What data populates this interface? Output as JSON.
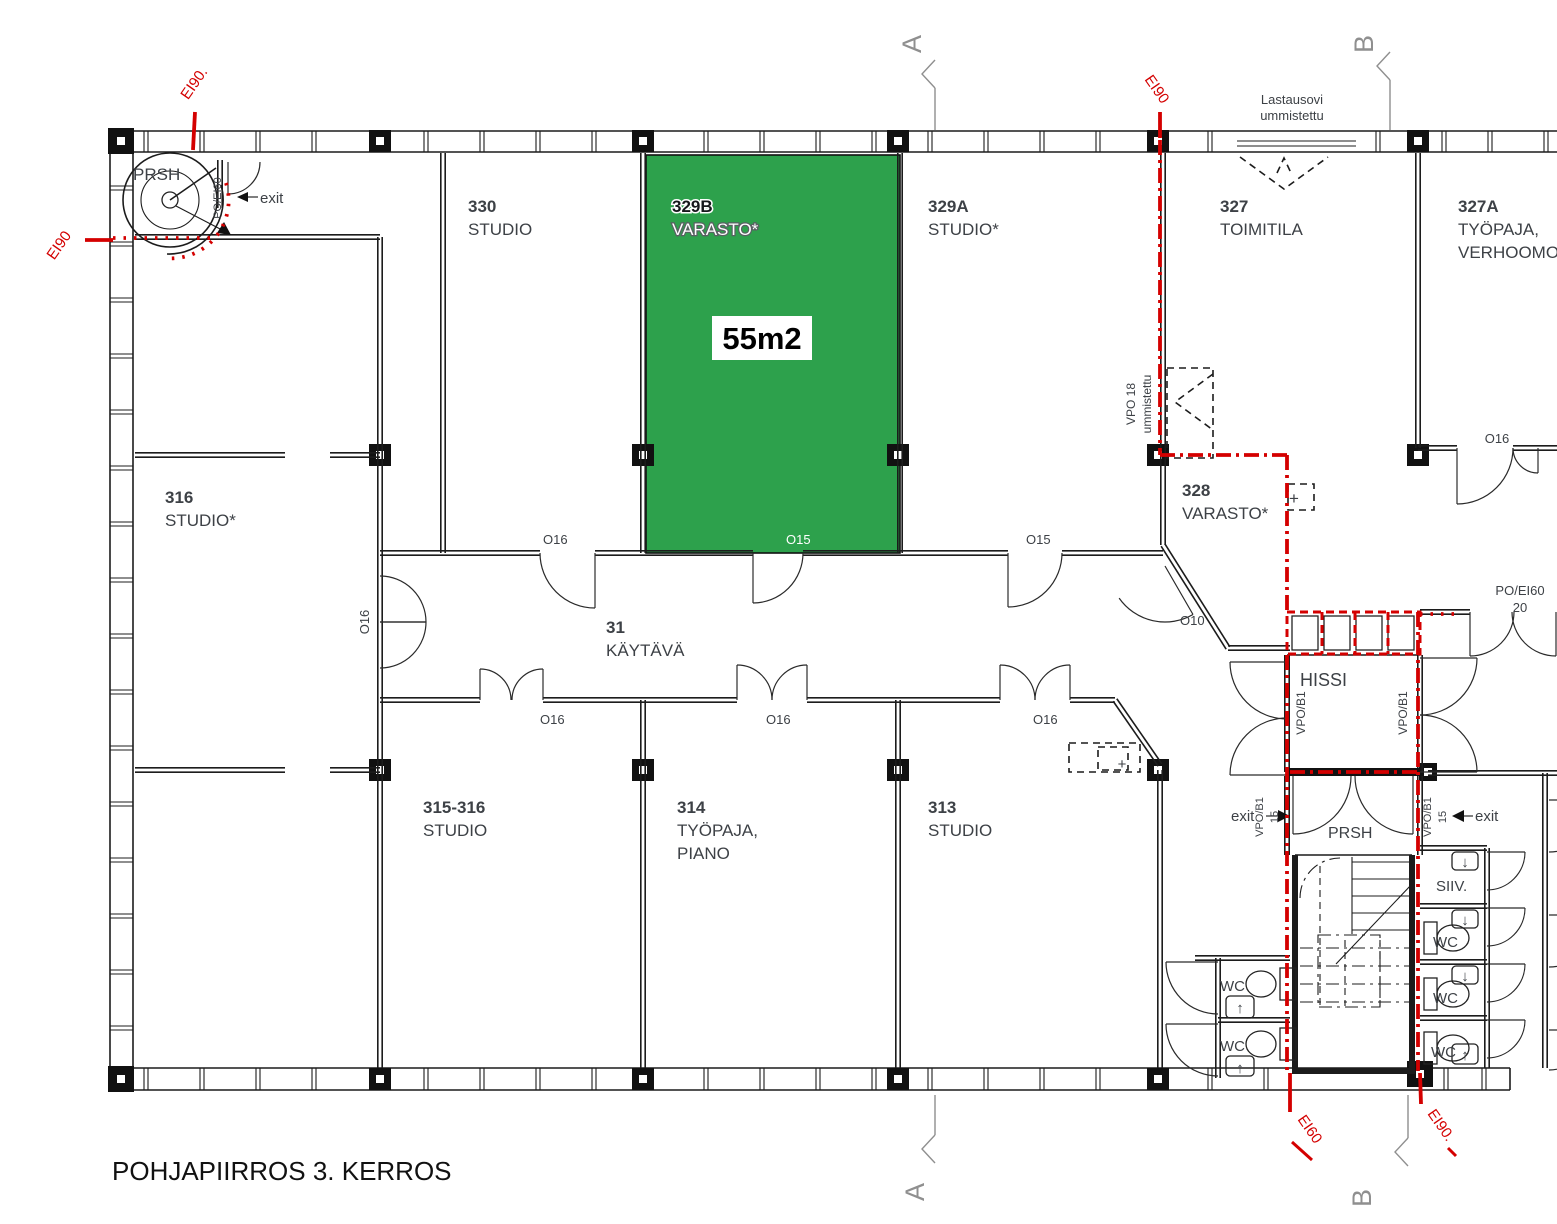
{
  "title": "POHJAPIIRROS 3. KERROS",
  "colors": {
    "highlight_green": "#2da14c",
    "fire_red": "#d40000",
    "wall_black": "#1c1c1c",
    "text_dark": "#3d4146",
    "marker_gray": "#8f8f8f"
  },
  "highlighted_room": {
    "id": "329B",
    "type": "VARASTO*",
    "area_label": "55m2"
  },
  "labels": [
    {
      "n": "plan-title",
      "t": "POHJAPIIRROS 3. KERROS",
      "x": 112,
      "y": 1180,
      "s": 26,
      "c": "#111111"
    },
    {
      "n": "room-330-number",
      "t": "330",
      "x": 468,
      "y": 212,
      "b": 1
    },
    {
      "n": "room-330-type",
      "t": "STUDIO",
      "x": 468,
      "y": 235
    },
    {
      "n": "room-329b-number",
      "t": "329B",
      "x": 672,
      "y": 212,
      "b": 1,
      "c": "#15181b",
      "st": "#ffffff",
      "sw": 3
    },
    {
      "n": "room-329b-type",
      "t": "VARASTO*",
      "x": 672,
      "y": 235,
      "c": "#ffffff",
      "st": "#5a5f63",
      "sw": 2.4
    },
    {
      "n": "room-329b-area",
      "t": "55m2",
      "x": 762,
      "y": 349,
      "s": 31,
      "b": 1,
      "c": "#000000",
      "a": "middle"
    },
    {
      "n": "room-329a-number",
      "t": "329A",
      "x": 928,
      "y": 212,
      "b": 1
    },
    {
      "n": "room-329a-type",
      "t": "STUDIO*",
      "x": 928,
      "y": 235
    },
    {
      "n": "room-327-number",
      "t": "327",
      "x": 1220,
      "y": 212,
      "b": 1
    },
    {
      "n": "room-327-type",
      "t": "TOIMITILA",
      "x": 1220,
      "y": 235
    },
    {
      "n": "room-327a-number",
      "t": "327A",
      "x": 1458,
      "y": 212,
      "b": 1
    },
    {
      "n": "room-327a-type-line1",
      "t": "TYÖPAJA,",
      "x": 1458,
      "y": 235
    },
    {
      "n": "room-327a-type-line2",
      "t": "VERHOOMO",
      "x": 1458,
      "y": 258
    },
    {
      "n": "room-316-number",
      "t": "316",
      "x": 165,
      "y": 503,
      "b": 1
    },
    {
      "n": "room-316-type",
      "t": "STUDIO*",
      "x": 165,
      "y": 526
    },
    {
      "n": "room-31-number",
      "t": "31",
      "x": 606,
      "y": 633,
      "b": 1
    },
    {
      "n": "room-31-type",
      "t": "KÄYTÄVÄ",
      "x": 606,
      "y": 656
    },
    {
      "n": "room-328-number",
      "t": "328",
      "x": 1182,
      "y": 496,
      "b": 1
    },
    {
      "n": "room-328-type",
      "t": "VARASTO*",
      "x": 1182,
      "y": 519
    },
    {
      "n": "room-315-316-number",
      "t": "315-316",
      "x": 423,
      "y": 813,
      "b": 1
    },
    {
      "n": "room-315-316-type",
      "t": "STUDIO",
      "x": 423,
      "y": 836
    },
    {
      "n": "room-314-number",
      "t": "314",
      "x": 677,
      "y": 813,
      "b": 1
    },
    {
      "n": "room-314-type-line1",
      "t": "TYÖPAJA,",
      "x": 677,
      "y": 836
    },
    {
      "n": "room-314-type-line2",
      "t": "PIANO",
      "x": 677,
      "y": 859
    },
    {
      "n": "room-313-number",
      "t": "313",
      "x": 928,
      "y": 813,
      "b": 1
    },
    {
      "n": "room-313-type",
      "t": "STUDIO",
      "x": 928,
      "y": 836
    },
    {
      "n": "label-hissi",
      "t": "HISSI",
      "x": 1300,
      "y": 686,
      "s": 18
    },
    {
      "n": "label-prsh-stair",
      "t": "PRSH",
      "x": 133,
      "y": 180,
      "s": 17
    },
    {
      "n": "label-prsh-lobby",
      "t": "PRSH",
      "x": 1328,
      "y": 838,
      "s": 16
    },
    {
      "n": "label-siiv",
      "t": "SIIV.",
      "x": 1436,
      "y": 891,
      "s": 15
    },
    {
      "n": "label-wc-right-1",
      "t": "WC",
      "x": 1433,
      "y": 947,
      "s": 15
    },
    {
      "n": "label-wc-right-2",
      "t": "WC",
      "x": 1433,
      "y": 1003,
      "s": 15
    },
    {
      "n": "label-wc-right-3",
      "t": "WC",
      "x": 1431,
      "y": 1057,
      "s": 15
    },
    {
      "n": "label-wc-left-1",
      "t": "WC",
      "x": 1220,
      "y": 991,
      "s": 15
    },
    {
      "n": "label-wc-left-2",
      "t": "WC",
      "x": 1220,
      "y": 1051,
      "s": 15
    },
    {
      "n": "door-o16-330",
      "t": "O16",
      "x": 543,
      "y": 544,
      "s": 13
    },
    {
      "n": "door-o15-329b",
      "t": "O15",
      "x": 786,
      "y": 544,
      "s": 13,
      "c": "#ffffff"
    },
    {
      "n": "door-o15-329a",
      "t": "O15",
      "x": 1026,
      "y": 544,
      "s": 13
    },
    {
      "n": "door-o16-315-316",
      "t": "O16",
      "x": 540,
      "y": 724,
      "s": 13
    },
    {
      "n": "door-o16-314",
      "t": "O16",
      "x": 766,
      "y": 724,
      "s": 13
    },
    {
      "n": "door-o16-313",
      "t": "O16",
      "x": 1033,
      "y": 724,
      "s": 13
    },
    {
      "n": "door-o16-corridor-west",
      "t": "O16",
      "x": 369,
      "y": 622,
      "s": 13,
      "r": -90,
      "a": "middle"
    },
    {
      "n": "door-o16-327a",
      "t": "O16",
      "x": 1497,
      "y": 443,
      "s": 13,
      "a": "middle"
    },
    {
      "n": "door-o10",
      "t": "O10",
      "x": 1180,
      "y": 625,
      "s": 13
    },
    {
      "n": "note-lastausovi-line1",
      "t": "Lastausovi",
      "x": 1292,
      "y": 104,
      "s": 13,
      "a": "middle"
    },
    {
      "n": "note-lastausovi-line2",
      "t": "ummistettu",
      "x": 1292,
      "y": 120,
      "s": 13,
      "a": "middle"
    },
    {
      "n": "note-vpo18-line1",
      "t": "VPO 18",
      "x": 1135,
      "y": 404,
      "s": 12,
      "r": -90,
      "a": "middle"
    },
    {
      "n": "note-vpo18-line2",
      "t": "ummistettu",
      "x": 1151,
      "y": 404,
      "s": 12,
      "r": -90,
      "a": "middle"
    },
    {
      "n": "note-po-ei60-line1",
      "t": "PO/EI60",
      "x": 1520,
      "y": 595,
      "s": 13,
      "a": "middle"
    },
    {
      "n": "note-po-ei60-line2",
      "t": "20",
      "x": 1520,
      "y": 612,
      "s": 13,
      "a": "middle"
    },
    {
      "n": "note-po-ei60-stair",
      "t": "PO/EI60",
      "x": 221,
      "y": 198,
      "s": 11,
      "r": -90,
      "a": "middle"
    },
    {
      "n": "exit-label-stair",
      "t": "exit",
      "x": 260,
      "y": 203,
      "s": 15
    },
    {
      "n": "exit-label-lobby",
      "t": "exit",
      "x": 1231,
      "y": 821,
      "s": 15
    },
    {
      "n": "exit-label-right",
      "t": "exit",
      "x": 1475,
      "y": 821,
      "s": 15
    },
    {
      "n": "note-vpo-b1-hissi-left",
      "t": "VPO/B1",
      "x": 1305,
      "y": 713,
      "s": 12,
      "r": -90,
      "a": "middle"
    },
    {
      "n": "note-vpo-b1-hissi-right",
      "t": "VPO/B1",
      "x": 1407,
      "y": 713,
      "s": 12,
      "r": -90,
      "a": "middle"
    },
    {
      "n": "note-vpo-b1-15-left-line1",
      "t": "VPO/B1",
      "x": 1263,
      "y": 817,
      "s": 11,
      "r": -90,
      "a": "middle"
    },
    {
      "n": "note-vpo-b1-15-left-line2",
      "t": "15",
      "x": 1278,
      "y": 817,
      "s": 11,
      "r": -90,
      "a": "middle"
    },
    {
      "n": "note-vpo-b1-15-right-line1",
      "t": "VPO/B1",
      "x": 1431,
      "y": 817,
      "s": 11,
      "r": -90,
      "a": "middle"
    },
    {
      "n": "note-vpo-b1-15-right-line2",
      "t": "15",
      "x": 1446,
      "y": 817,
      "s": 11,
      "r": -90,
      "a": "middle"
    },
    {
      "n": "fire-ei90-top-left",
      "t": "EI90.",
      "x": 198,
      "y": 86,
      "s": 15,
      "c": "#d40000",
      "r": -55,
      "a": "middle"
    },
    {
      "n": "fire-ei90-left",
      "t": "EI90",
      "x": 63,
      "y": 248,
      "s": 15,
      "c": "#d40000",
      "r": -55,
      "a": "middle"
    },
    {
      "n": "fire-ei90-top-middle",
      "t": "EI90",
      "x": 1153,
      "y": 92,
      "s": 15,
      "c": "#d40000",
      "r": 55,
      "a": "middle"
    },
    {
      "n": "fire-ei60-bottom-left",
      "t": "EI60",
      "x": 1306,
      "y": 1132,
      "s": 15,
      "c": "#d40000",
      "r": 55,
      "a": "middle"
    },
    {
      "n": "fire-ei90-bottom-right",
      "t": "EI90.",
      "x": 1437,
      "y": 1128,
      "s": 15,
      "c": "#d40000",
      "r": 55,
      "a": "middle"
    },
    {
      "n": "section-marker-a-top",
      "t": "A",
      "x": 921,
      "y": 44,
      "s": 27,
      "c": "#8f8f8f",
      "r": -90,
      "a": "middle"
    },
    {
      "n": "section-marker-a-bottom",
      "t": "A",
      "x": 924,
      "y": 1192,
      "s": 27,
      "c": "#8f8f8f",
      "r": -90,
      "a": "middle"
    },
    {
      "n": "section-marker-b-top",
      "t": "B",
      "x": 1373,
      "y": 44,
      "s": 27,
      "c": "#8f8f8f",
      "r": -90,
      "a": "middle"
    },
    {
      "n": "section-marker-b-bottom",
      "t": "B",
      "x": 1371,
      "y": 1198,
      "s": 27,
      "c": "#8f8f8f",
      "r": -90,
      "a": "middle"
    },
    {
      "n": "sink-arrow-siiv",
      "t": "↓",
      "x": 1465,
      "y": 867,
      "s": 15,
      "a": "middle"
    },
    {
      "n": "sink-arrow-wc-right-1",
      "t": "↓",
      "x": 1465,
      "y": 925,
      "s": 15,
      "a": "middle"
    },
    {
      "n": "sink-arrow-wc-right-2",
      "t": "↓",
      "x": 1465,
      "y": 981,
      "s": 15,
      "a": "middle"
    },
    {
      "n": "sink-arrow-wc-right-3",
      "t": "↑",
      "x": 1465,
      "y": 1060,
      "s": 15,
      "a": "middle"
    },
    {
      "n": "sink-arrow-wc-left-1",
      "t": "↑",
      "x": 1240,
      "y": 1013,
      "s": 15,
      "a": "middle"
    },
    {
      "n": "sink-arrow-wc-left-2",
      "t": "↑",
      "x": 1240,
      "y": 1073,
      "s": 15,
      "a": "middle"
    },
    {
      "n": "symbol-plus-328",
      "t": "+",
      "x": 1294,
      "y": 504,
      "s": 17,
      "a": "middle"
    },
    {
      "n": "symbol-plus-lobby",
      "t": "+",
      "x": 1122,
      "y": 769,
      "s": 15,
      "a": "middle"
    }
  ]
}
